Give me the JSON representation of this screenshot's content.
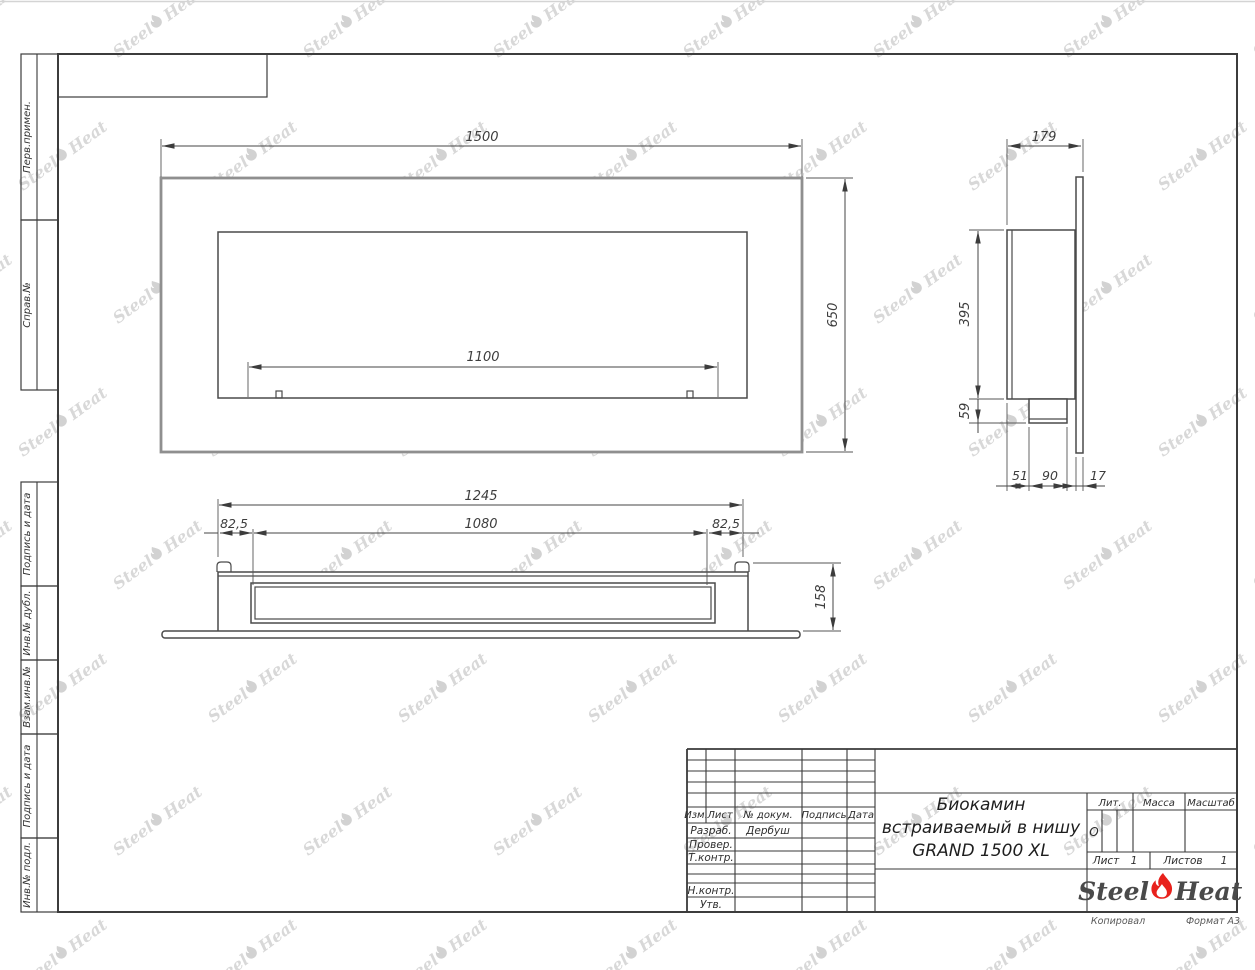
{
  "colors": {
    "accent_red": "#e8211c",
    "line": "#3c3c3c",
    "watermark": "#d8d8d8"
  },
  "watermark": {
    "steel": "Steel",
    "heat": "Heat"
  },
  "frame": {
    "strips": {
      "perv": "Перв.примен.",
      "sprav": "Справ.№",
      "podp1": "Подпись и дата",
      "dubl": "Инв.№ дубл.",
      "vzam": "Взам.инв.№",
      "podp2": "Подпись и дата",
      "podl": "Инв.№ подл."
    }
  },
  "dims": {
    "front": {
      "width": "1500",
      "height": "650",
      "burner": "1100"
    },
    "side": {
      "depth": "179",
      "body_height": "395",
      "tray_height": "59",
      "offset": "51",
      "tray_width": "90",
      "panel": "17"
    },
    "top": {
      "niche": "1245",
      "left_margin": "82,5",
      "slot": "1080",
      "right_margin": "82,5",
      "depth": "158"
    }
  },
  "title_block": {
    "columns": {
      "izm": "Изм.",
      "list": "Лист",
      "doc": "№ докум.",
      "sign": "Подпись",
      "date": "Дата"
    },
    "rows": {
      "developed": "Разраб.",
      "checked": "Провер.",
      "tcontrol": "Т.контр.",
      "ncontrol": "Н.контр.",
      "approved": "Утв."
    },
    "developer_name": "Дербуш",
    "title_line1": "Биокамин",
    "title_line2": "встраиваемый в нишу",
    "title_line3": "GRAND 1500 XL",
    "lit_label": "Лит.",
    "lit_value": "О",
    "mass_label": "Масса",
    "scale_label": "Масштаб",
    "sheet_label": "Лист",
    "sheet_value": "1",
    "sheets_label": "Листов",
    "sheets_value": "1",
    "logo": {
      "steel": "Steel",
      "heat": "Heat"
    },
    "footer": {
      "copied": "Копировал",
      "format": "Формат А3"
    }
  }
}
